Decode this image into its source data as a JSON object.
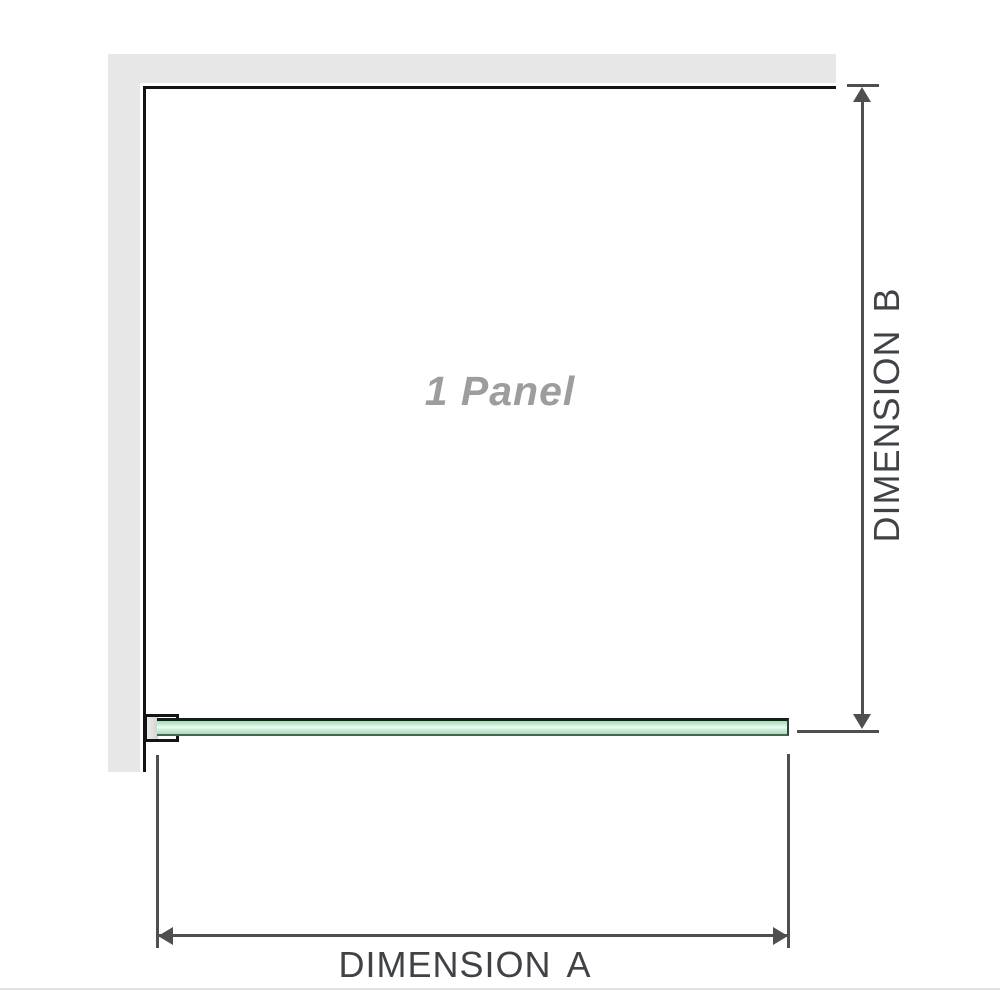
{
  "diagram": {
    "panel_label": "1 Panel",
    "dimensions": {
      "a_label": "DIMENSION A",
      "b_label": "DIMENSION B"
    }
  },
  "colors": {
    "background": "#ffffff",
    "wall_fill": "#e7e7e7",
    "panel_border": "#141414",
    "glass_fill": "#b9e4c9",
    "glass_highlight": "#eef9f2",
    "glass_edge_dark": "#15201a",
    "dimension_line": "#4f4f4f",
    "dimension_label_text": "#3f4347",
    "panel_label_text": "#9d9d9d",
    "page_edge_line": "#e4e4e0"
  }
}
